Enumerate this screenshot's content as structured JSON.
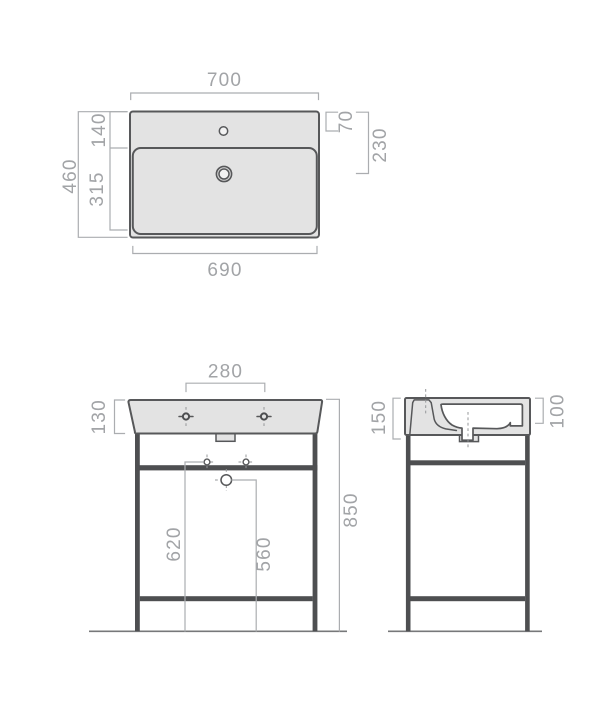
{
  "drawing": {
    "colors": {
      "background": "#ffffff",
      "ceramic_fill": "#e3e3e3",
      "outline": "#57585a",
      "steel_frame": "#4e4f51",
      "dimension_lines": "#abadb0",
      "dimension_text": "#a2a4a7"
    },
    "top_view": {
      "dims": {
        "outer_width": "700",
        "bowl_width": "690",
        "total_depth": "460",
        "deck_depth": "140",
        "bowl_depth": "315",
        "tap_hole_offset": "70",
        "drain_offset": "230"
      }
    },
    "front_view": {
      "dims": {
        "tap_hole_spacing": "280",
        "basin_height": "130",
        "total_height": "850",
        "hole_height": "620",
        "drain_height": "560"
      }
    },
    "side_view": {
      "dims": {
        "front_height": "150",
        "back_height": "100"
      }
    }
  }
}
